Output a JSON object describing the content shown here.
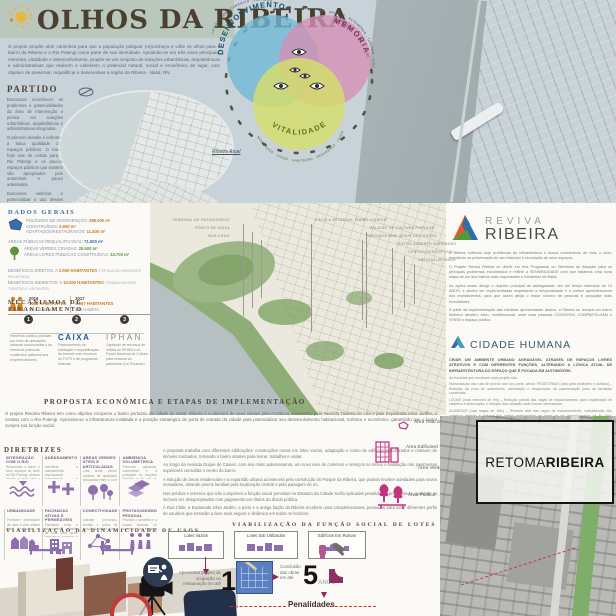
{
  "title": {
    "text": "OLHOS DA RIBEIRA",
    "intro": "O projeto propõe abrir caminhos para que a população potiguar (re)conheça e volte os olhos para o bairro da Ribeira e o Rio Potengi como parte de sua identidade. Apoiando-se em três eixos principais: memória, vitalidade e desenvolvimento, propõe-se um conjunto de soluções urbanísticas, arquitetônicas e administrativas que realcem e valorizem o potencial natural, social e econômico do lugar, com objetivo de preservar, requalificar e desenvolver a região da Ribeira - Natal, RN."
  },
  "partido": {
    "heading": "PARTIDO",
    "paragraphs": [
      "Buscamos reconhecer os problemas e potencialidades da área de intervenção e pensar em soluções urbanísticas, arquitetônicas e administrativas integradas.",
      "O primeiro desafio é enfrentar a baixa qualidade dos espaços públicos. O bairro hoje vive de costas para o Rio Potengi e os poucos espaços públicos que existem são apropriados pelo automóvel e pouco adensados.",
      "Buscamos valorizar e potencializar o uso desses espaços, (re)conectando e fomentando espaços do bairro através de soluções integradas, como a construção de uma rede cicloviária, abertura de novas vias e a criação de novas centralidades."
    ]
  },
  "venn": {
    "caption": "Ribeira Atual",
    "circles": [
      {
        "name": "DESENVOLVIMENTO",
        "edge": "ECONOMIA · SUSTENTABILIDADE · COMÉRCIO · EMPREGO",
        "color": "#6fb9d6"
      },
      {
        "name": "MEMÓRIA",
        "edge": "COMUNIDADE · PATRIMÔNIO · TURISMO · CULTURA",
        "color": "#d690b5"
      },
      {
        "name": "VITALIDADE",
        "edge": "MOBILIDADE · SAÚDE · HABITAÇÃO · SEGURANÇA · LAZER",
        "color": "#d5de6b"
      }
    ]
  },
  "dados": {
    "heading": "DADOS GERAIS",
    "poligono": [
      {
        "label": "POLÍGONO DE INTERVENÇÃO:",
        "value": "288.000 m²"
      },
      {
        "label": "CONSTRUÍDOS:",
        "value": "6.690 m²"
      },
      {
        "label": "ADAPTADOS/RESTAURADOS:",
        "value": "11.400 m²"
      }
    ],
    "requalificadas": {
      "label": "ÁREAS PÚBLICAS REQUALIFICADAS:",
      "value": "71.500 m²"
    },
    "verdes": [
      {
        "label": "ÁREAS VERDES CRIADAS:",
        "value": "25.500 m²"
      },
      {
        "label": "ÁREAS LIVRES PÚBLICAS CONSTRUÍDAS:",
        "value": "34.700 m²"
      }
    ],
    "beneficios": [
      {
        "label": "BENEFÍCIOS DIRETOS: A",
        "value": "2.500 HABITANTES",
        "note": "(POPULAÇÃO RESIDENTE PROJETADA)"
      },
      {
        "label": "BENEFÍCIOS INDIRETOS:",
        "value": "+ 10.000 HABITANTES",
        "note": "(TRABALHADORES, TURISTAS E VISITANTES)"
      }
    ],
    "pop": {
      "a": {
        "year": "2016",
        "hab": "1648 HABITANTES",
        "dens": "59,2 HAB/HA"
      },
      "b": {
        "year": "2017",
        "hab": "4.067 HABITANTES",
        "dens": "141 HAB/HA"
      }
    }
  },
  "financiamento": {
    "heading": "MECANISMOS DE FINANCIAMENTO",
    "steps": [
      {
        "num": "1",
        "text": "Parcerias público-privadas por meio de operações urbanas consorciadas e da venda de potencial construtivo adicional aos empreendedores."
      },
      {
        "num": "2",
        "text": "Financiamento de habitação e requalificação de imóveis com recursos do FGTS e de programas federais.",
        "logo": "CAIXA"
      },
      {
        "num": "3",
        "text": "Captação de recursos de editais do IPHAN e do Fundo Nacional de Cultura para restauro do patrimônio (Lei Rouanet).",
        "logo": "IPHAN"
      }
    ]
  },
  "map_labels": {
    "left": [
      "TERMINAL DE PASSAGEIROS",
      "PORTO DE NATAL",
      "RUA CHILE"
    ],
    "right": [
      "ESCOLA ESTADUAL ISABEL GONDIM",
      "PALÁCIO DE CULTURA POPULAR",
      "PARÓQUIA BOM JESUS DAS DORES",
      "TEATRO ALBERTO MARANHÃO",
      "CENTRO DESPORTIVO",
      "ANTIGA ILZE MAUR"
    ]
  },
  "proposta": {
    "heading": "PROPOSTA ECONÔMICA E ETAPAS DE IMPLEMENTAÇÃO",
    "intro": "O projeto Retoma Ribeira tem como objetivo recuperar o bairro portuário da cidade de Natal. Ribeira é a abertura de seus visuais pela Fortaleza, mantendo, pela Avenida Tavares de Lira e pela Esplanada Silva Jardim, o contato com o Rio Potengi. Aproveita-se a infraestrutura instalada e a posição estratégica de porta de entrada da cidade para potencializar seu desenvolvimento habitacional, turístico e econômico, garantindo que o bairro cumpra sua função social.",
    "paragraphs": [
      "A proposta trabalha com diferentes edificações: construções novas em lotes vazios, adaptação e reúso de edifícios subutilizados e restauro de imóveis tombados, tornando o bairro atrativo para morar, trabalhar e visitar.",
      "Ao longo da Avenida Duque de Caxias, com seu misto adensamento, um novo eixo de comércio e serviços no térreo e habitação nos pavimentos superiores consolida o centro do bairro.",
      "A indução de áreas residenciais e a expansão urbana acontecerá pela construção do Parque da Ribeira, que poderá receber atividades para novos moradores, atraindo jovens famílias pela localização central e pela paisagem do rio.",
      "Nos prédios e terrenos que não cumprirem a função social previstos no Estatuto da Cidade serão aplicadas penalidades progressivas, podendo os imóveis ser desapropriados com pagamento em títulos da dívida pública.",
      "A Rua Chile, a Esplanada Silva Jardim, o porto e a antiga fiação da Ribeira recebem usos complementares, pensados para atrair diferentes perfis de usuários que tornarão a área mais segura e dinâmica em todos os horários."
    ]
  },
  "reviva": {
    "logo_top": "REVIVA",
    "logo_bottom": "RIBEIRA",
    "paragraphs": [
      "A Ribeira enfrenta hoje problemas de infraestrutura e busca crescimento de todo o ciclo, incentivos na preservação de seu histórico e renovação de seus espaços.",
      "O Projeto Reviva Ribeira se divide em três Programas ou Diretrizes de Atuação para os principais problemas encontrados e reflete a SENSIBILIDADE com que tratamos uma nova etapa de um dos bairros mais importantes e existentes de Natal.",
      "As ações visam atingir o objetivo principal de salvaguardar, em um tempo estimado de 10 ANOS, e devem ser implementadas respeitando a temporalidade e o melhor aproveitamento dos investimentos, para que assim atinja o maior número de pessoas e conquiste mais investidores.",
      "A partir da implementação das medidas apresentadas abaixo, a Ribeira se tornará um bairro histórico atrativo, ativo, multifuncional, onde suas pessoas CONVIVEM, COMPARTILHAM e VIVEM o espaço público."
    ]
  },
  "cidade_humana": {
    "logo_text": "CIDADE HUMANA",
    "intro": "CRIAR UM AMBIENTE URBANO AGRADÁVEL ATRAVÉS DE ESPAÇOS LIVRES ATRATIVOS E COM DIFERENTES FUNÇÕES, ALTERANDO A LÓGICA ATUAL DE INFRAESTRUTURA DO ESPAÇO QUE É FOCADA EM AUTOMÓVEIS.",
    "lead": "As medidas que envolvem esse projeto são:",
    "bullets": [
      "Humanização das ruas de acordo com seu porte, sendo: PEDESTRIAIS (vias para pedestres e ciclistas) – Redução da zona de automóveis, valorização e recuperação da pavimentação junto às fachadas comerciais;",
      "LOCAIS (ruas menores de 9m) – Redução parcial das vagas de estacionamento para implantação de canteiros e arborização, e redução das calçadas onde houver necessidade;",
      "ALAMEDAS (ruas largas de 18m) – Retirada total das vagas de estacionamento, redistribuição dos canteiros centrais e retirada dos ônibus estacionados ao longo da via (reposicionados na Av. Eng. Hildebrando de Góis);",
      "Revitalização das praças locais com inserção de novas atividades e proposição de novos usos."
    ]
  },
  "areas": {
    "total": {
      "label": "Área Total do Polígono :",
      "value": "28 ha"
    },
    "edificavel": {
      "label": "Área Edificável :",
      "value": "159296 m²"
    },
    "verde": {
      "label": "Área Verde :",
      "value": "6594 m²"
    },
    "publica": {
      "label": "Área Pública :",
      "value": "150877 m²"
    }
  },
  "retoma": {
    "light": "RETOMA",
    "bold": "RIBEIRA"
  },
  "diretrizes": {
    "heading": "DIRETRIZES",
    "items": [
      {
        "title": "INTEGRAÇÃO COM O RIO",
        "desc": "Reconectar o bairro e seus espaços de lazer ao Rio Potengi, abrindo visuais e usos para a orla."
      },
      {
        "title": "ADENSAMENTO",
        "desc": "Incentivar o adensamento populacional aproveitando a infraestrutura urbana já existente no bairro."
      },
      {
        "title": "ÁREAS VERDES ÚTEIS E ARTICULADAS",
        "desc": "Criar áreas verdes públicas de qualidade, articuladas entre si, com funções de lazer e permanência."
      },
      {
        "title": "AMBIÊNCIA VOLUMÉTRICA",
        "desc": "Preservar gabaritos, volumetrias e a paisagem do conjunto histórico e da orla do bairro."
      },
      {
        "title": "URBANIDADE",
        "desc": "Promover diversidade de usos e vida urbana ativa em todos os horários do dia."
      },
      {
        "title": "FACHADAS ATIVAS E PERMEÁVEIS",
        "desc": "Fachadas vivas e permeáveis voltadas às ruas para gerar segurança, comércio e movimento."
      },
      {
        "title": "CONECTIVIDADE",
        "desc": "Articular percursos, modais e polos de atração do bairro com o restante da cidade."
      },
      {
        "title": "PROTAGONISMO PESSOAL",
        "desc": "Priorizar o pedestre e a escala humana no desenho dos espaços públicos e das ruas."
      }
    ]
  },
  "dinamicidade": {
    "heading": "VIABILIZAÇÃO DA DINAMICIDADE DE USOS"
  },
  "funcao_social": {
    "heading": "VIABILIZAÇÃO DA FUNÇÃO SOCIAL DE LOTES",
    "boxes": [
      "Lotes Vazios",
      "Lotes Sub Utilizados",
      "Edifícios Em Ruínas"
    ],
    "step1": {
      "text": "Apresentar projeto de ocupação ou restauração em até",
      "num": "1",
      "unit": "ANO"
    },
    "step2": {
      "text": "Conclusão das obras em até",
      "num": "5",
      "unit": "ANOS"
    },
    "penalty": "Penalidades"
  },
  "colors": {
    "magenta": "#c13580",
    "purple": "#8d6fae",
    "blue": "#3a6ca8",
    "orange": "#d9822b",
    "green": "#5e9440",
    "dark": "#4c4339",
    "red_dash": "#c0392b"
  }
}
